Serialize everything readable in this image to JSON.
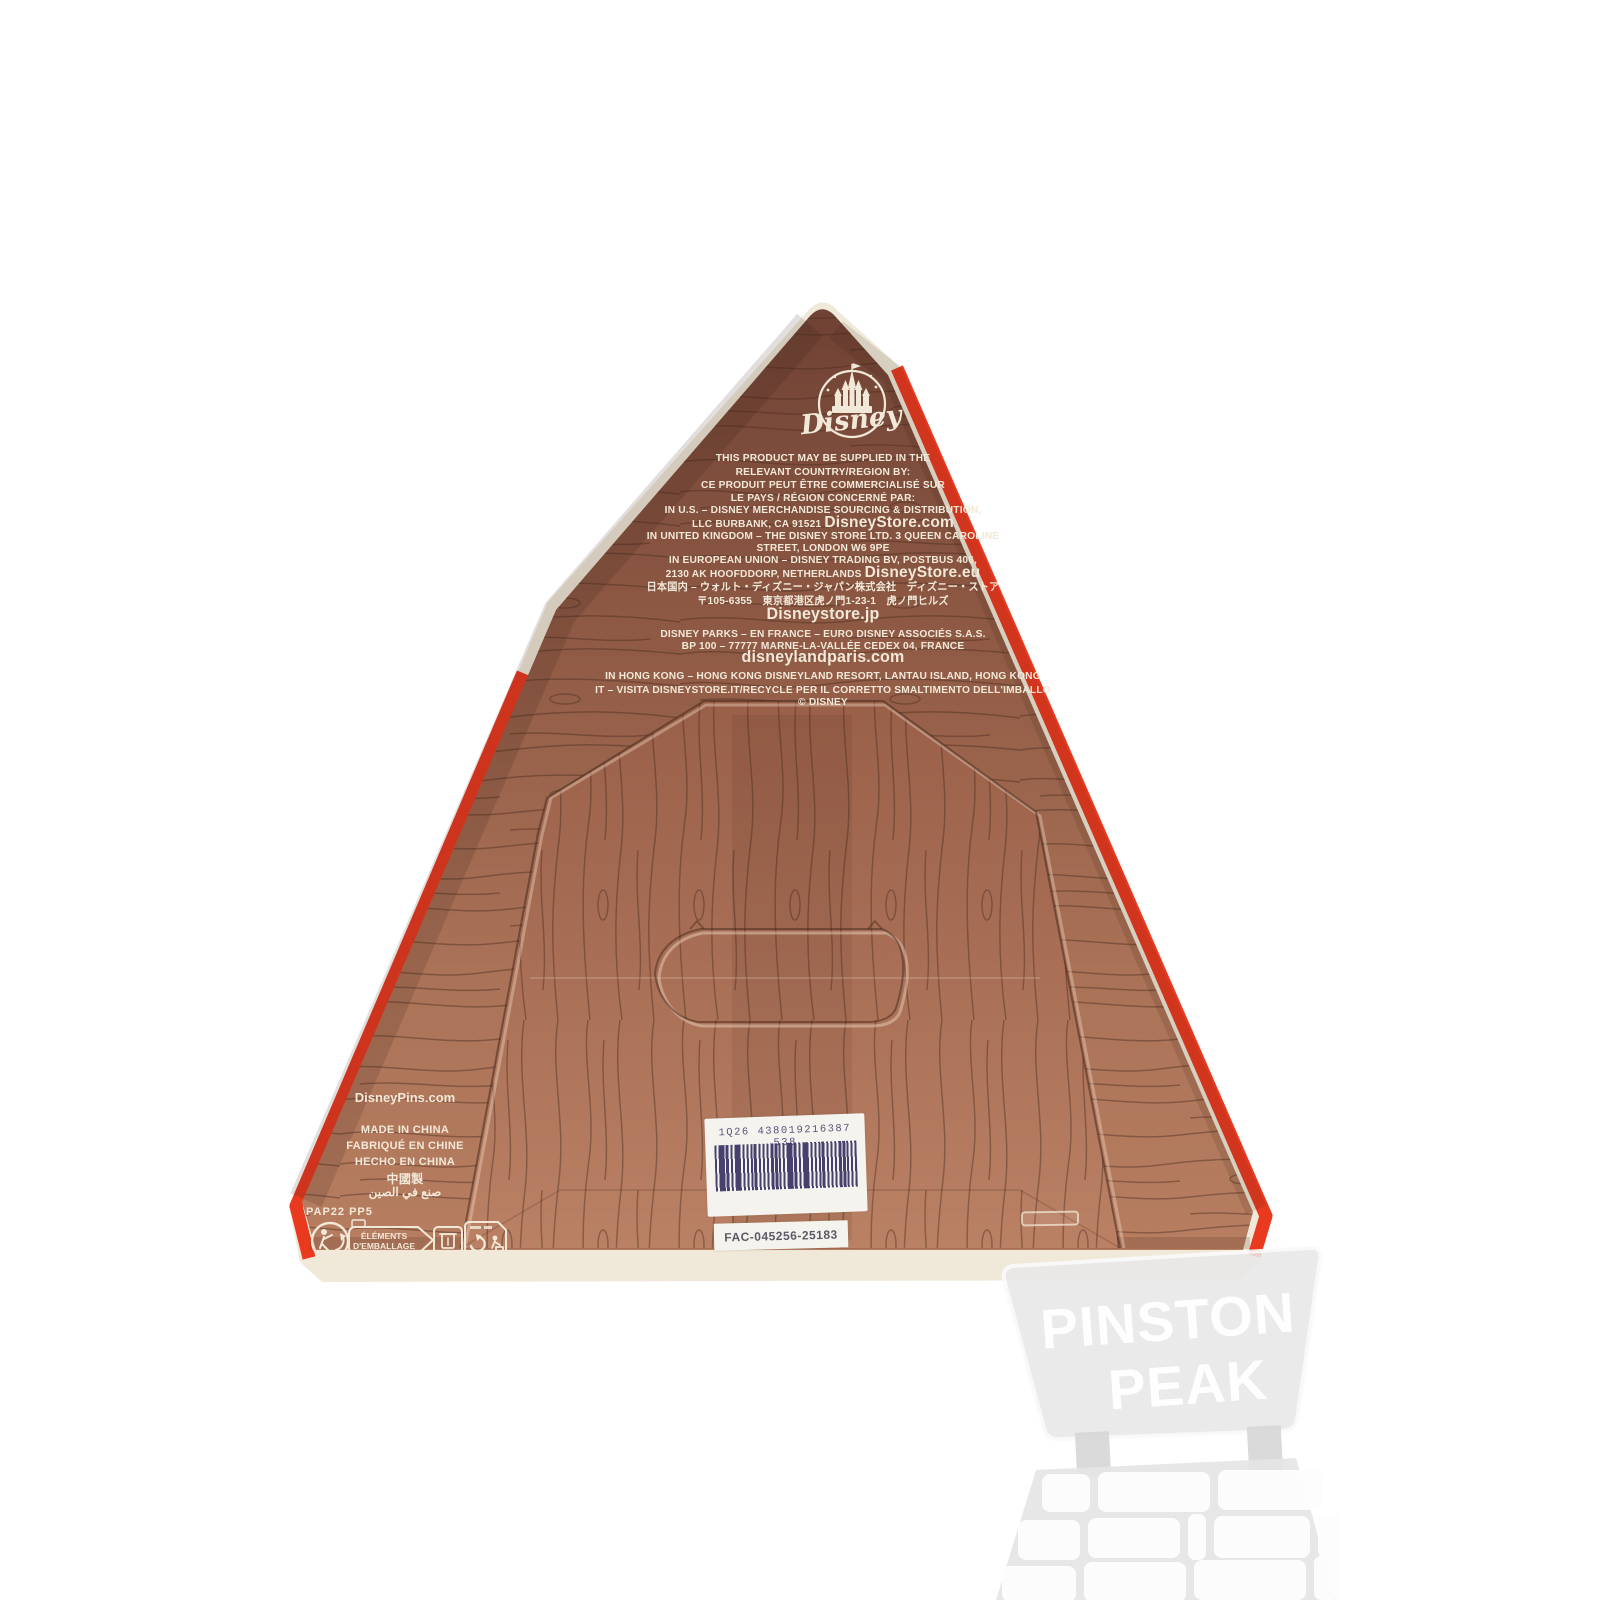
{
  "product_label": {
    "brand_logo": "Disney",
    "legal_lines": [
      {
        "a": "THIS PRODUCT MAY BE SUPPLIED IN THE"
      },
      {
        "a": "RELEVANT COUNTRY/REGION BY:"
      },
      {
        "a": "CE PRODUIT PEUT ÊTRE COMMERCIALISÉ SUR"
      },
      {
        "a": "LE PAYS / RÉGION CONCERNÉ PAR:"
      },
      {
        "a": "IN U.S. – DISNEY MERCHANDISE SOURCING & DISTRIBUTION,"
      },
      {
        "a": "LLC BURBANK, CA 91521 ",
        "b": "DisneyStore.com"
      },
      {
        "a": "IN UNITED KINGDOM – THE DISNEY STORE LTD. 3 QUEEN CAROLINE"
      },
      {
        "a": "STREET, LONDON W6 9PE"
      },
      {
        "a": "IN EUROPEAN UNION – DISNEY TRADING BV, POSTBUS 406,"
      },
      {
        "a": "2130 AK HOOFDDORP, NETHERLANDS ",
        "b": "DisneyStore.eu"
      },
      {
        "a": "日本国内 – ウォルト・ディズニー・ジャパン株式会社　ディズニー・ストア"
      },
      {
        "a": "〒105-6355　東京都港区虎ノ門1-23-1　虎ノ門ヒルズ"
      },
      {
        "b": "Disneystore.jp"
      },
      {
        "a": "DISNEY PARKS – EN FRANCE – EURO DISNEY ASSOCIÉS S.A.S."
      },
      {
        "a": "BP 100 – 77777 MARNE-LA-VALLÉE CEDEX 04, FRANCE"
      },
      {
        "b": "disneylandparis.com"
      },
      {
        "a": "IN HONG KONG – HONG KONG DISNEYLAND RESORT, LANTAU ISLAND, HONG KONG"
      },
      {
        "a": "IT – VISITA DISNEYSTORE.IT/RECYCLE PER IL CORRETTO SMALTIMENTO DELL'IMBALLO"
      },
      {
        "a": "© DISNEY"
      }
    ],
    "website_left": "DisneyPins.com",
    "origin_lines": [
      "MADE IN CHINA",
      "FABRIQUÉ EN CHINE",
      "HECHO EN CHINA",
      "中國製",
      "صنع في الصين"
    ],
    "material_code": "PAP22 PP5",
    "packaging_sorting": {
      "line1": "ÉLÉMENTS",
      "line2": "D'EMBALLAGE"
    },
    "barcode": {
      "human_readable": "1Q26 438019216387 538",
      "fac_code": "FAC-045256-25183"
    }
  },
  "watermark": {
    "line1": "PINSTON",
    "line2": "PEAK"
  },
  "icons": [
    "disney-castle-logo",
    "triman-recycling-icon",
    "elements-emballage-bin-icon",
    "recycle-tidyman-sticker-icon"
  ],
  "colors": {
    "box_red": "#e93a20",
    "box_brown_dark": "#6e4134",
    "box_brown_light": "#b77e61",
    "edge_cream": "#f0e9d9",
    "label_text_cream": "#f2e8d8",
    "barcode_ink": "#46406e",
    "watermark_gray": "#e7e7e7"
  }
}
